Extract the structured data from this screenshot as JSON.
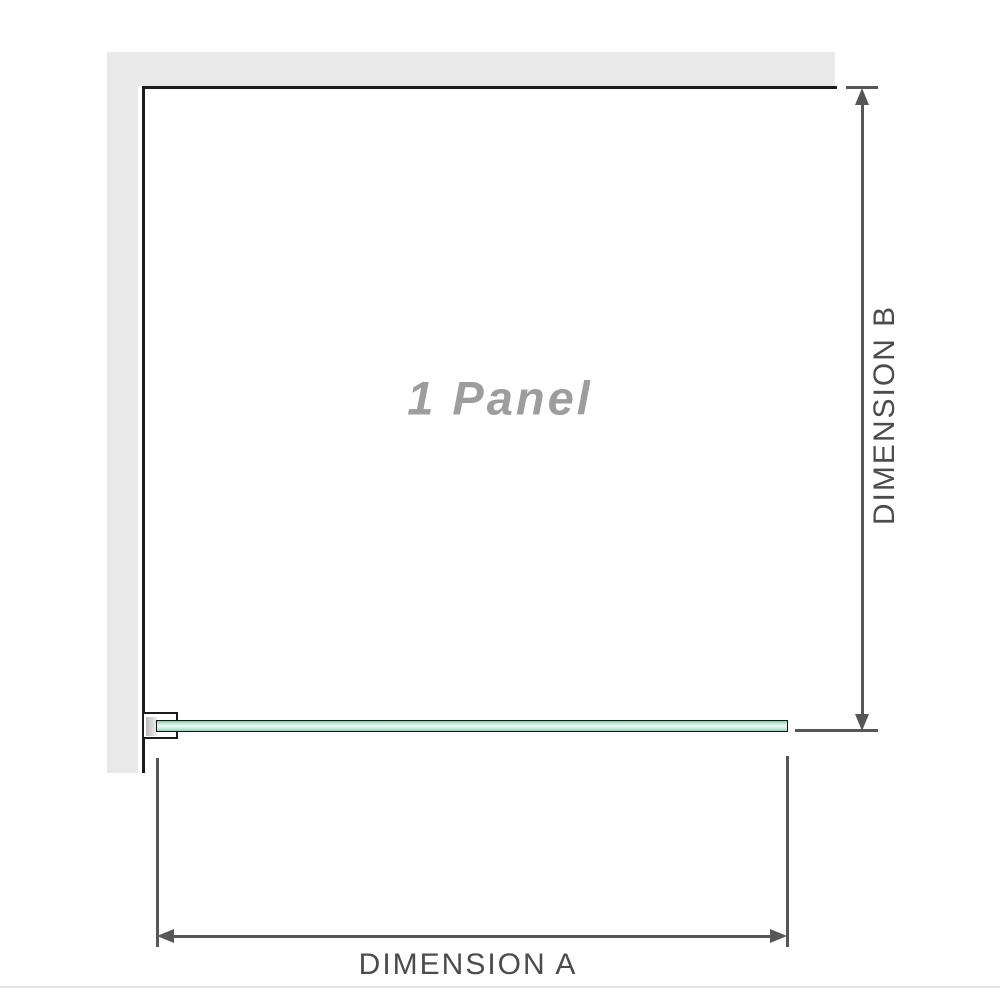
{
  "labels": {
    "panel": "1 Panel",
    "dimension_a": "DIMENSION A",
    "dimension_b": "DIMENSION B"
  },
  "colors": {
    "wall": "#e9e9e9",
    "panel_outline": "#1b1b1b",
    "dimension_line": "#565656",
    "dimension_text": "#4c4c4c",
    "panel_label_text": "#9d9d9d",
    "glass_edge": "#161616",
    "glass_green_top": "#85caa4",
    "glass_green_light": "#ecf9f3",
    "glass_green_bottom": "#90d1b1",
    "bracket_fill_dark": "#bbbbbb",
    "bracket_fill_light": "#eeeeee",
    "baseline": "#e7e5e1"
  }
}
